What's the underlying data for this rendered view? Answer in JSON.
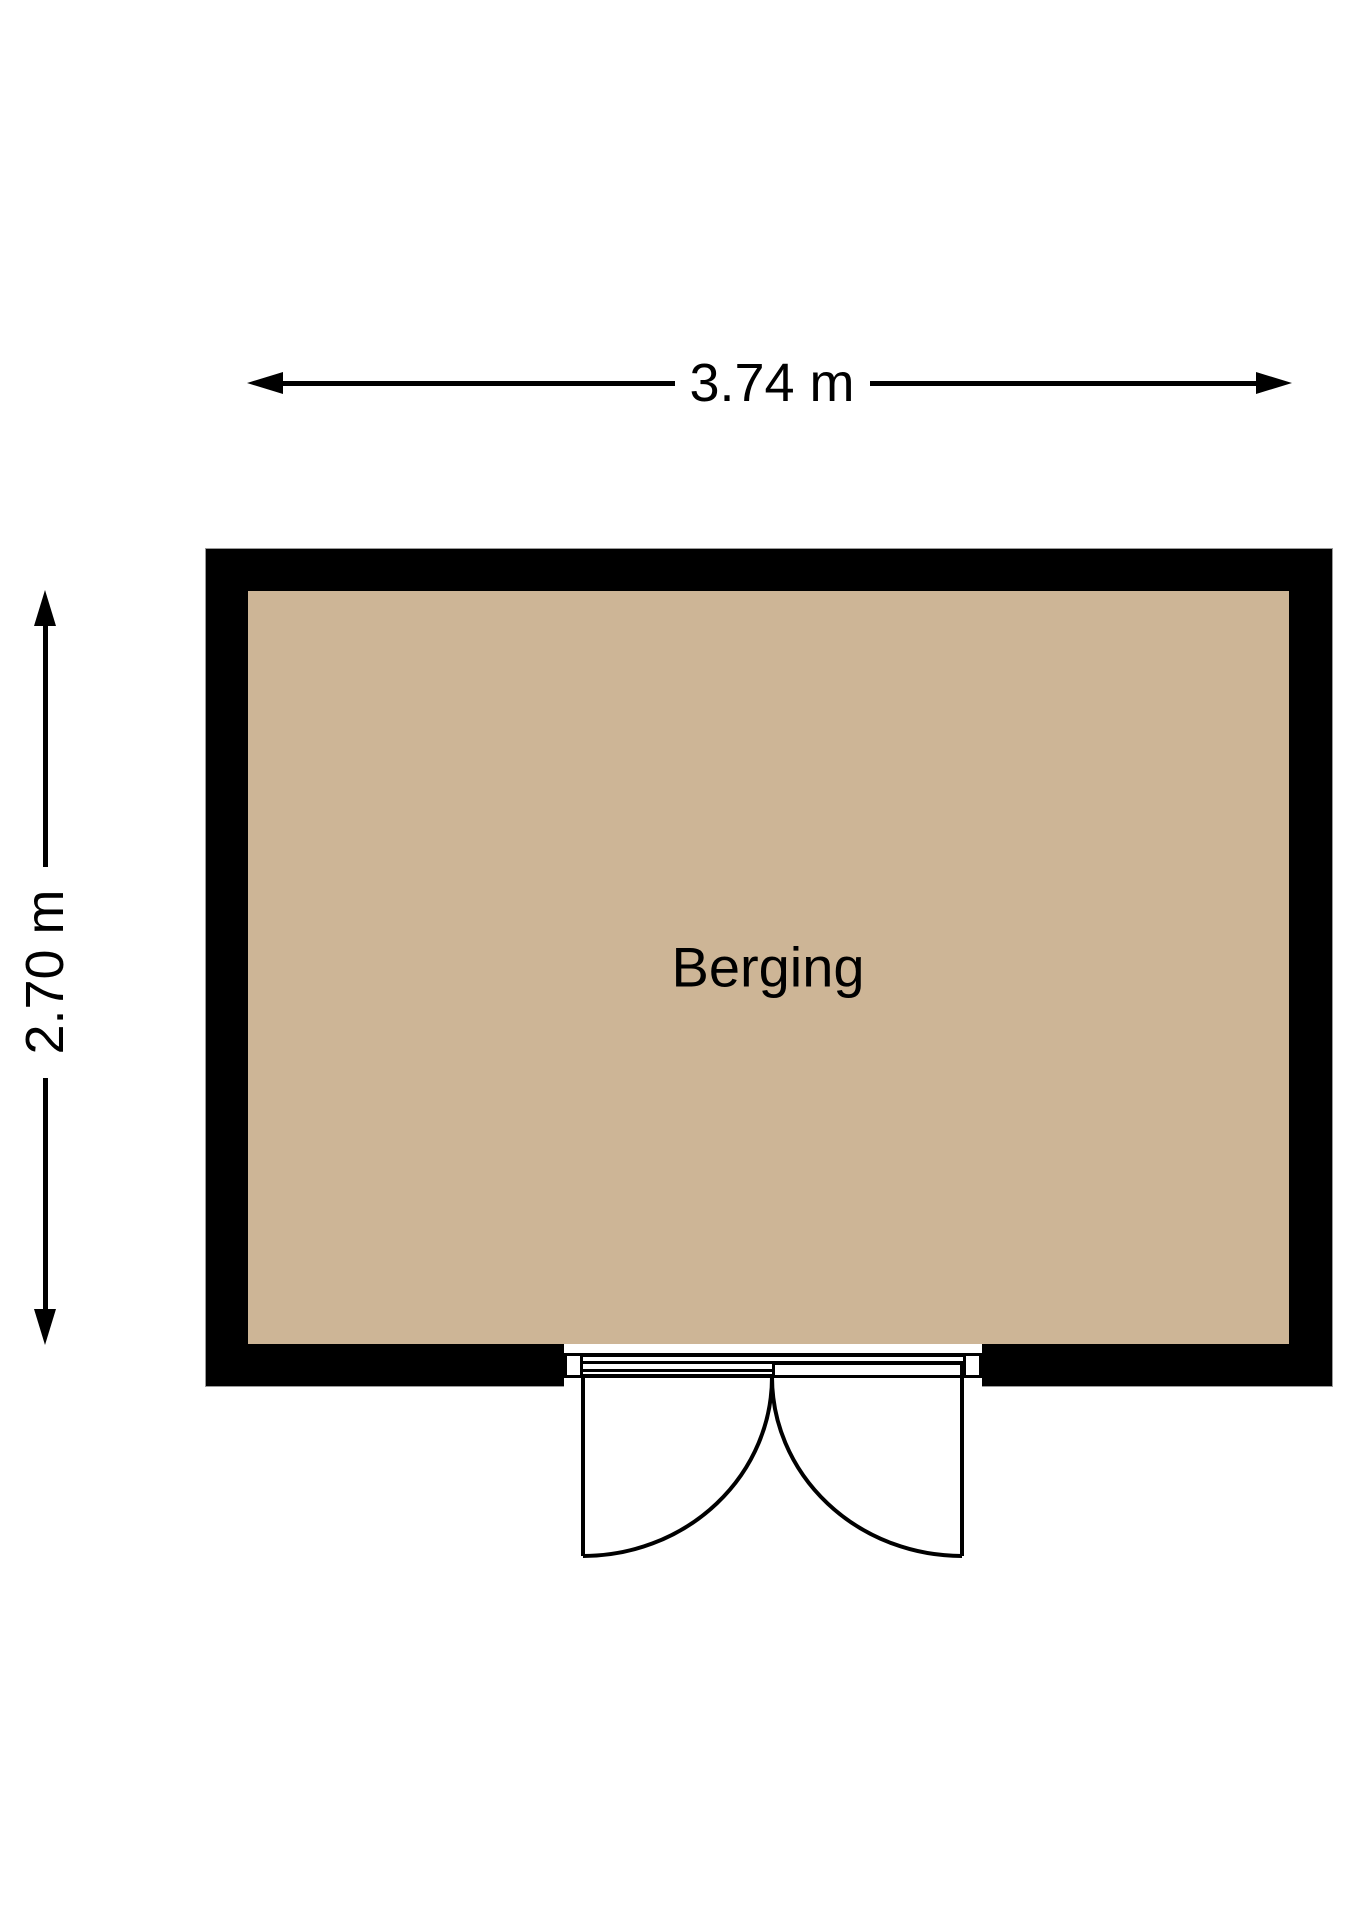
{
  "plan": {
    "room": {
      "label": "Berging",
      "floor_color": "#cdb596",
      "wall_color": "#000000"
    },
    "dimensions": {
      "width_label": "3.74 m",
      "height_label": "2.70 m"
    }
  }
}
